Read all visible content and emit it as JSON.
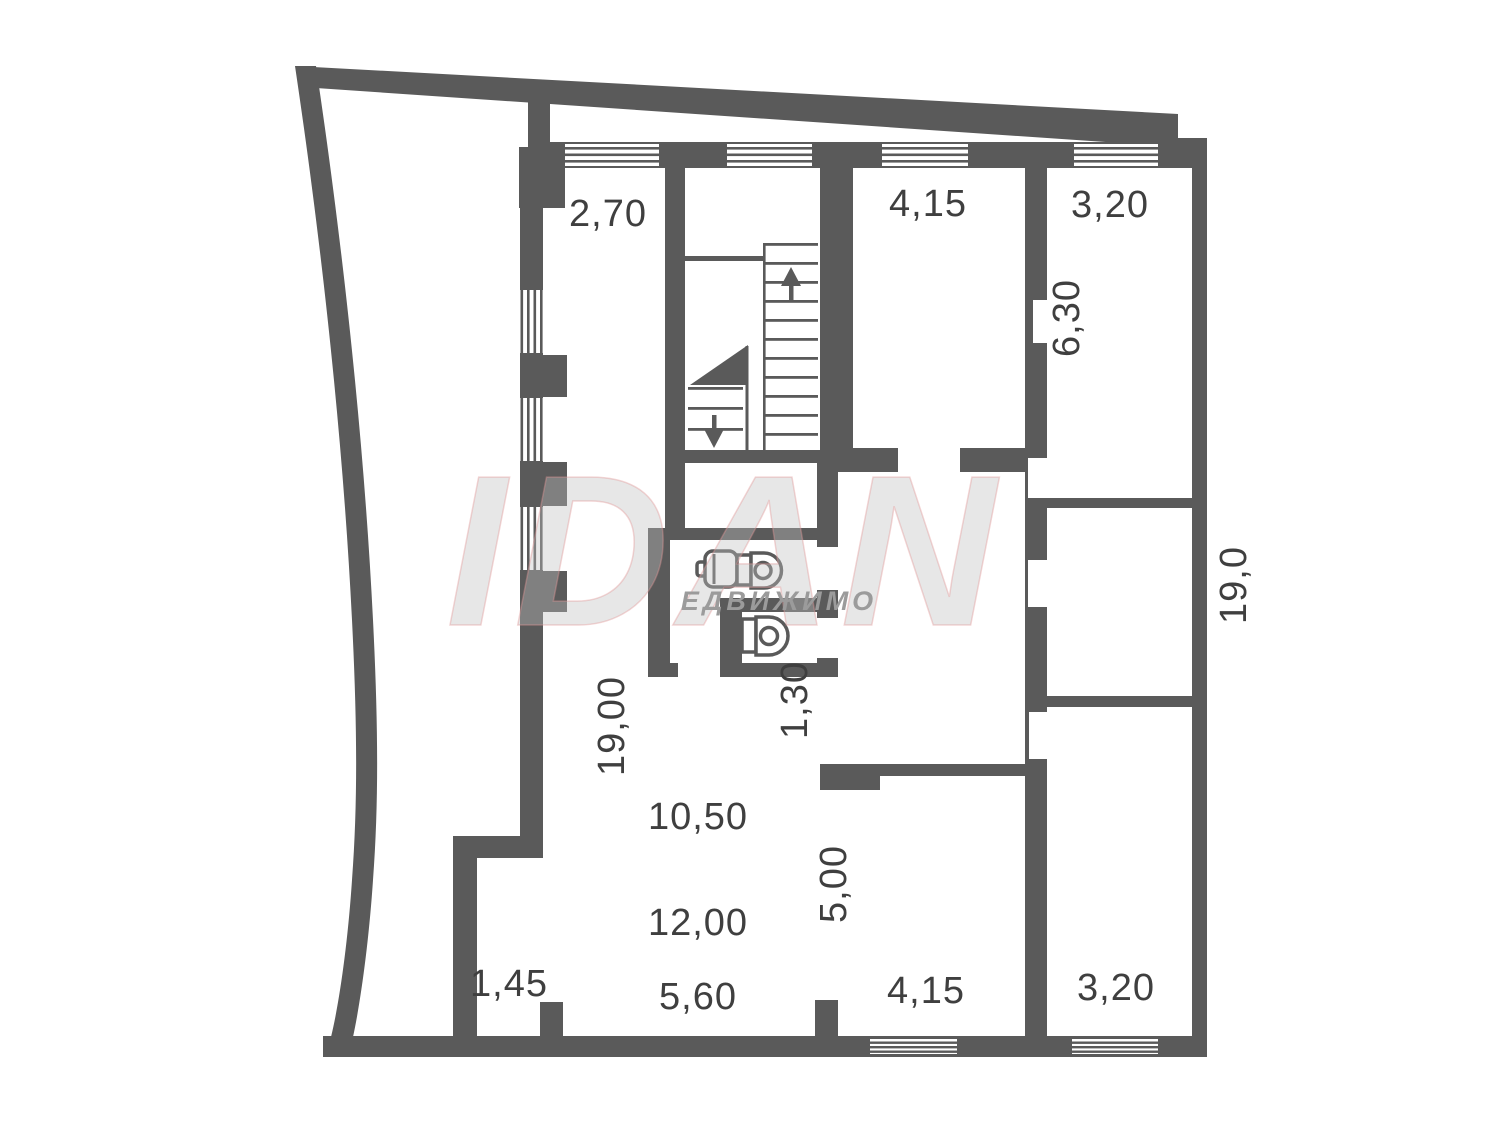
{
  "plan": {
    "colors": {
      "wall": "#5a5a5a",
      "label": "#3f3f3f",
      "watermark_sub": "#9b9b9b"
    },
    "dims": {
      "top_left_room_width": "2,70",
      "top_mid_room_width": "4,15",
      "top_right_room_width": "3,20",
      "top_right_room_depth": "6,30",
      "building_depth_right": "19,0",
      "left_room_depth": "19,00",
      "wc_width": "1,30",
      "hall_upper_width": "10,50",
      "alcove_depth": "5,00",
      "hall_mid_width": "12,00",
      "nook_width": "1,45",
      "hall_lower_width": "5,60",
      "bottom_mid_room_width": "4,15",
      "bottom_right_room_width": "3,20"
    },
    "watermark": {
      "logo": "IDAN",
      "subtext": "ЕДВИЖИМО"
    }
  }
}
